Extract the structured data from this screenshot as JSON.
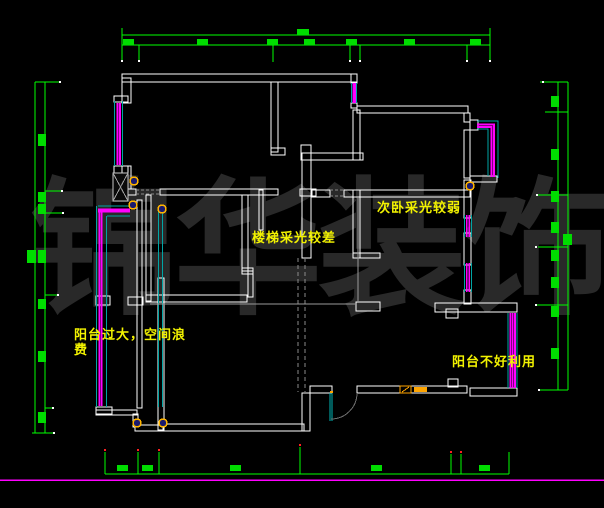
{
  "drawing": {
    "watermark": "锦华装饰",
    "annotations": {
      "staircase": "楼梯采光较差",
      "secondary_bedroom": "次卧采光较弱",
      "left_balcony": "阳台过大，空间浪费",
      "right_balcony": "阳台不好利用"
    }
  },
  "colors": {
    "background": "#000000",
    "wall": "#ffffff",
    "dimension": "#00ff00",
    "window": "#ff00ff",
    "window_frame": "#00a5a5",
    "annotation": "#f2f200",
    "watermark": "#292929",
    "fixture": "#ffa500",
    "axis_marker": "#ff0000",
    "layout_line": "#ff00ff"
  }
}
